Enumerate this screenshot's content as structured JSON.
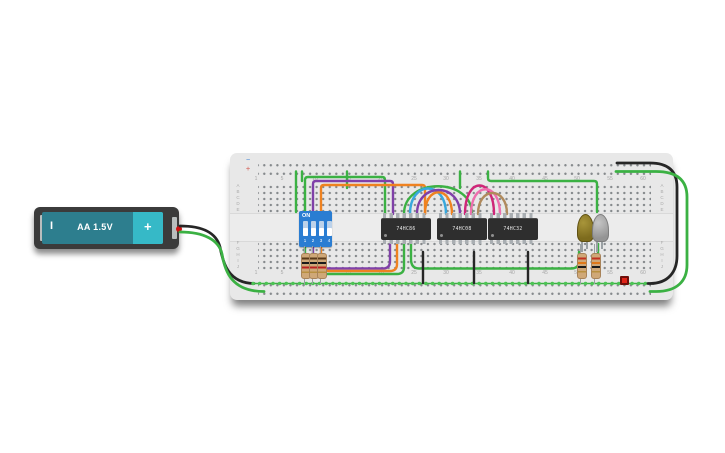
{
  "battery": {
    "label": "AA 1.5V",
    "minus_mark": "I",
    "plus_mark": "+",
    "body_color": "#2d7e8e",
    "cap_color": "#36b9c7",
    "case_color": "#3b3b3b"
  },
  "breadboard": {
    "color": "#e8e8e8",
    "rail_minus": "−",
    "rail_plus": "+",
    "cols": [
      "1",
      "5",
      "10",
      "15",
      "20",
      "25",
      "30",
      "35",
      "40",
      "45",
      "50",
      "55",
      "60"
    ],
    "rows_top": [
      "A",
      "B",
      "C",
      "D",
      "E"
    ],
    "rows_bottom": [
      "F",
      "G",
      "H",
      "I",
      "J"
    ]
  },
  "dip_switch": {
    "label": "ON",
    "positions": [
      "1",
      "2",
      "3",
      "4"
    ],
    "color": "#2a7dd2"
  },
  "ics": [
    {
      "label": "74HC86"
    },
    {
      "label": "74HC08"
    },
    {
      "label": "74HC32"
    }
  ],
  "leds": [
    {
      "name": "yellow-led",
      "color": "#8f7d2a"
    },
    {
      "name": "gray-led",
      "color": "#a9a9a9"
    }
  ],
  "indicator_color": "#e02418",
  "wires": {
    "green": "#3bb143",
    "black": "#262626",
    "purple": "#8040a8",
    "orange": "#ef8220",
    "cyan": "#38a8dd",
    "magenta": "#cf2779",
    "pink": "#ee6fae",
    "brown": "#b08a5c",
    "bus_dot": "#4cc454"
  }
}
